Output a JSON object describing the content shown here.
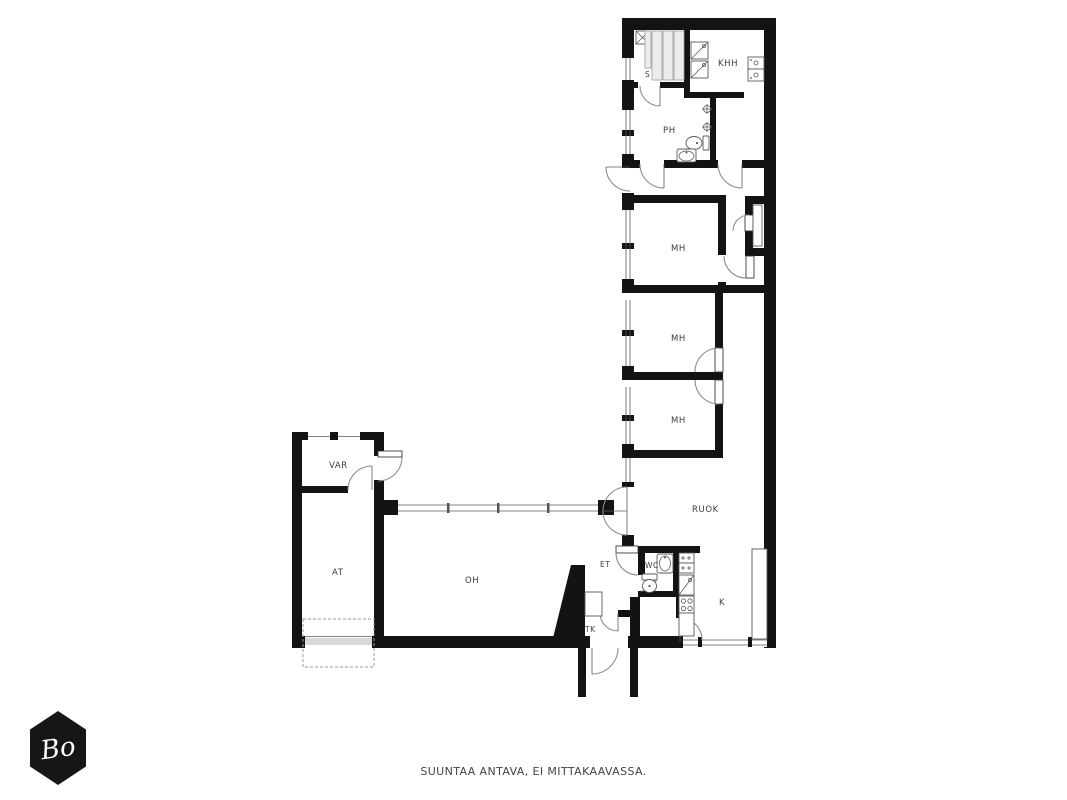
{
  "rooms": {
    "s": "S",
    "khh": "KHH",
    "ph": "PH",
    "mh1": "MH",
    "mh2": "MH",
    "mh3": "MH",
    "ruok": "RUOK",
    "var": "VAR",
    "at": "AT",
    "oh": "OH",
    "et": "ET",
    "wc": "WC",
    "k": "K",
    "tk": "TK"
  },
  "footer": {
    "disclaimer": "SUUNTAA ANTAVA, EI MITTAKAAVASSA."
  },
  "logo": {
    "text": "Bo"
  },
  "colors": {
    "wall": "#131313",
    "door_arc": "#8d8d8d",
    "bench_fill": "#ececec",
    "garage_band": "#d8d8d8",
    "logo_bg": "#161616",
    "label_text": "#3c3c3c"
  }
}
